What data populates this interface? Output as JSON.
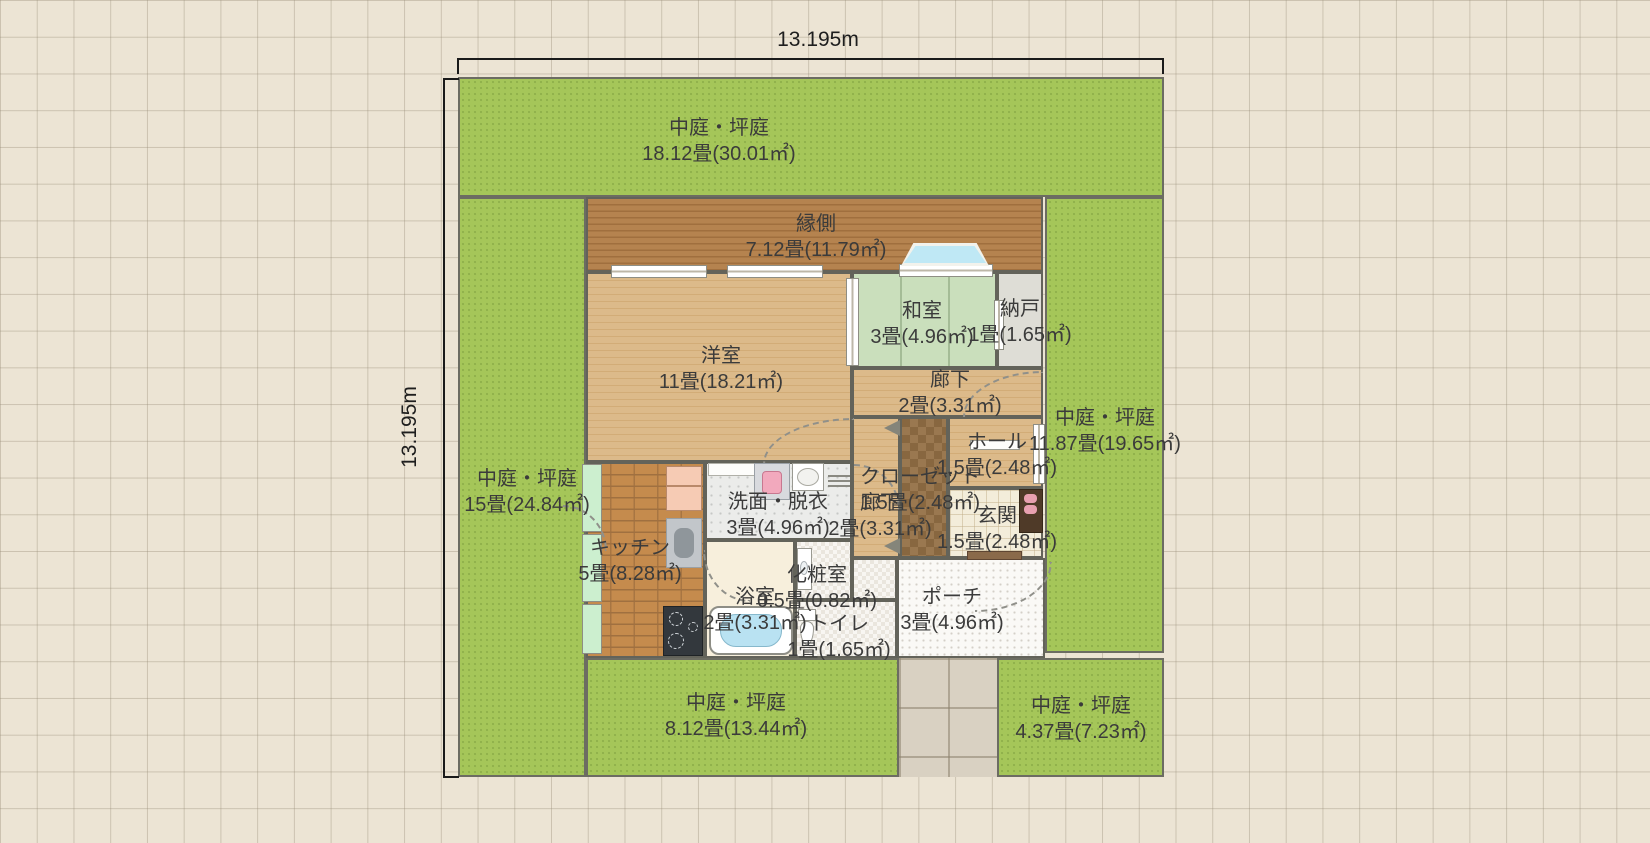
{
  "dimensions": {
    "width_label": "13.195m",
    "height_label": "13.195m"
  },
  "regions": {
    "garden_top": {
      "name": "中庭・坪庭",
      "area": "18.12畳(30.01㎡)"
    },
    "garden_left": {
      "name": "中庭・坪庭",
      "area": "15畳(24.84㎡)"
    },
    "garden_right": {
      "name": "中庭・坪庭",
      "area": "11.87畳(19.65㎡)"
    },
    "garden_bottom": {
      "name": "中庭・坪庭",
      "area": "8.12畳(13.44㎡)"
    },
    "garden_bottom_right": {
      "name": "中庭・坪庭",
      "area": "4.37畳(7.23㎡)"
    },
    "engawa": {
      "name": "縁側",
      "area": "7.12畳(11.79㎡)"
    },
    "yoshitsu": {
      "name": "洋室",
      "area": "11畳(18.21㎡)"
    },
    "washitsu": {
      "name": "和室",
      "area": "3畳(4.96㎡)"
    },
    "nando": {
      "name": "納戸",
      "area": "1畳(1.65㎡)"
    },
    "roka_upper": {
      "name": "廊下",
      "area": "2畳(3.31㎡)"
    },
    "hall": {
      "name": "ホール",
      "area": "1.5畳(2.48㎡)"
    },
    "closet": {
      "name": "クローゼット",
      "area": "1.5畳(2.48㎡)"
    },
    "roka_lower": {
      "name": "廊下",
      "area": "2畳(3.31㎡)"
    },
    "genkan": {
      "name": "玄関",
      "area": "1.5畳(2.48㎡)"
    },
    "porch": {
      "name": "ポーチ",
      "area": "3畳(4.96㎡)"
    },
    "senmen": {
      "name": "洗面・脱衣",
      "area": "3畳(4.96㎡)"
    },
    "kitchen": {
      "name": "キッチン",
      "area": "5畳(8.28㎡)"
    },
    "bath": {
      "name": "浴室",
      "area": "2畳(3.31㎡)"
    },
    "keshoshitsu": {
      "name": "化粧室",
      "area": "0.5畳(0.82㎡)"
    },
    "toilet": {
      "name": "トイレ",
      "area": "1畳(1.65㎡)"
    }
  },
  "fixtures": [
    "bay-window",
    "sliding-door",
    "refrigerator",
    "kitchen-sink",
    "stove",
    "counter",
    "washing-machine",
    "bathroom-sink",
    "towel-rack",
    "bathtub",
    "toilet",
    "vanity",
    "shoe-cabinet",
    "slippers",
    "clothes-hanger",
    "entrance-door",
    "door-swing",
    "window"
  ],
  "colors": {
    "background": "#ece4d4",
    "garden": "#a5c659",
    "engawa_wood": "#b5834f",
    "room_wood": "#dcba8a",
    "tatami": "#cadfbc",
    "kitchen_brick": "#c58b4d",
    "closet_checker": "#9a7850",
    "wall": "#63635a",
    "bay_window_glass": "#bfe8f5",
    "label_text": "#3b3b3b",
    "dimension_line": "#1a1a1a"
  }
}
